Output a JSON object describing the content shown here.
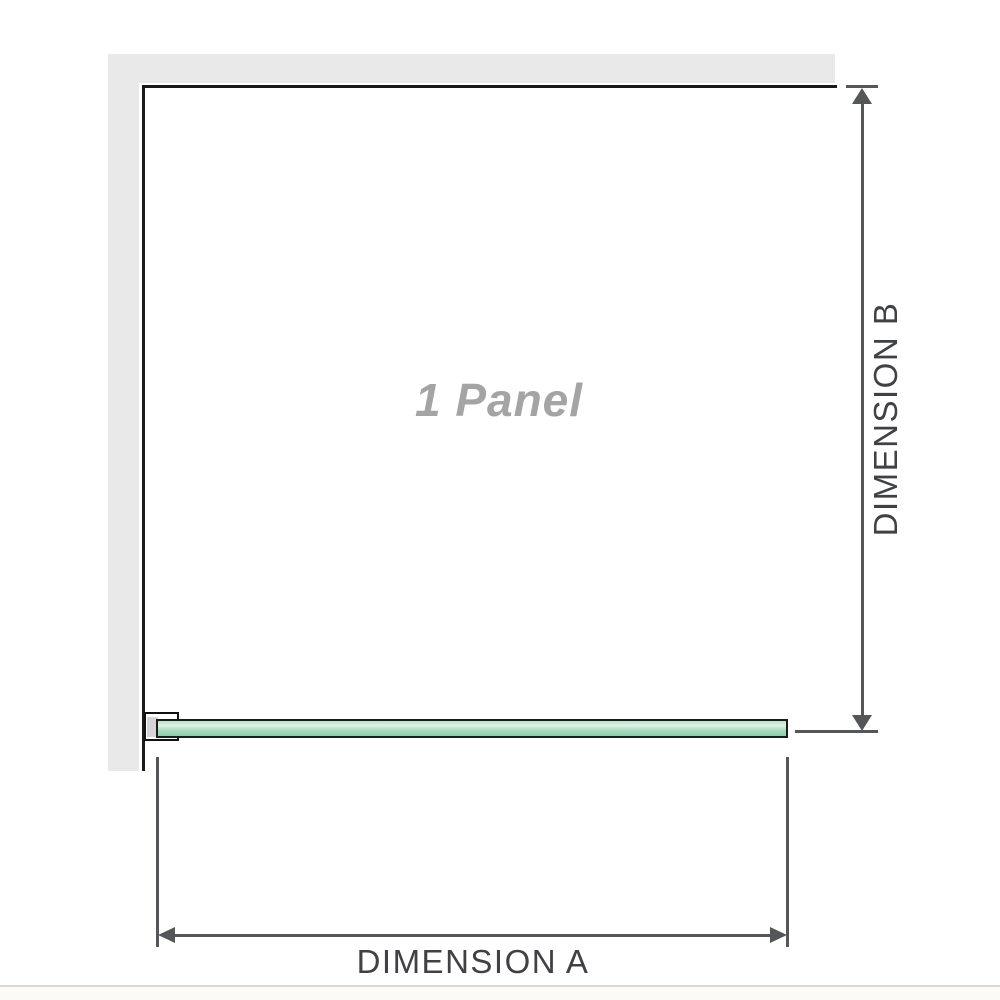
{
  "diagram": {
    "panel_label": "1 Panel",
    "dimension_a": {
      "label": "DIMENSION A"
    },
    "dimension_b": {
      "label": "DIMENSION B"
    },
    "colors": {
      "wall_fill": "#e9e9e9",
      "panel_outline": "#1a1a1a",
      "dimension_line": "#55565a",
      "dimension_text": "#3f4144",
      "panel_label_text": "#a4a4a4",
      "glass_green_light": "#def2e7",
      "glass_green_mid": "#a9dabf",
      "glass_green_dark": "#8ecdad",
      "glass_outline": "#1b1b1b",
      "bracket_insert_fill": "#d5d5d5",
      "bottom_rule": "#dcd9d1"
    }
  }
}
